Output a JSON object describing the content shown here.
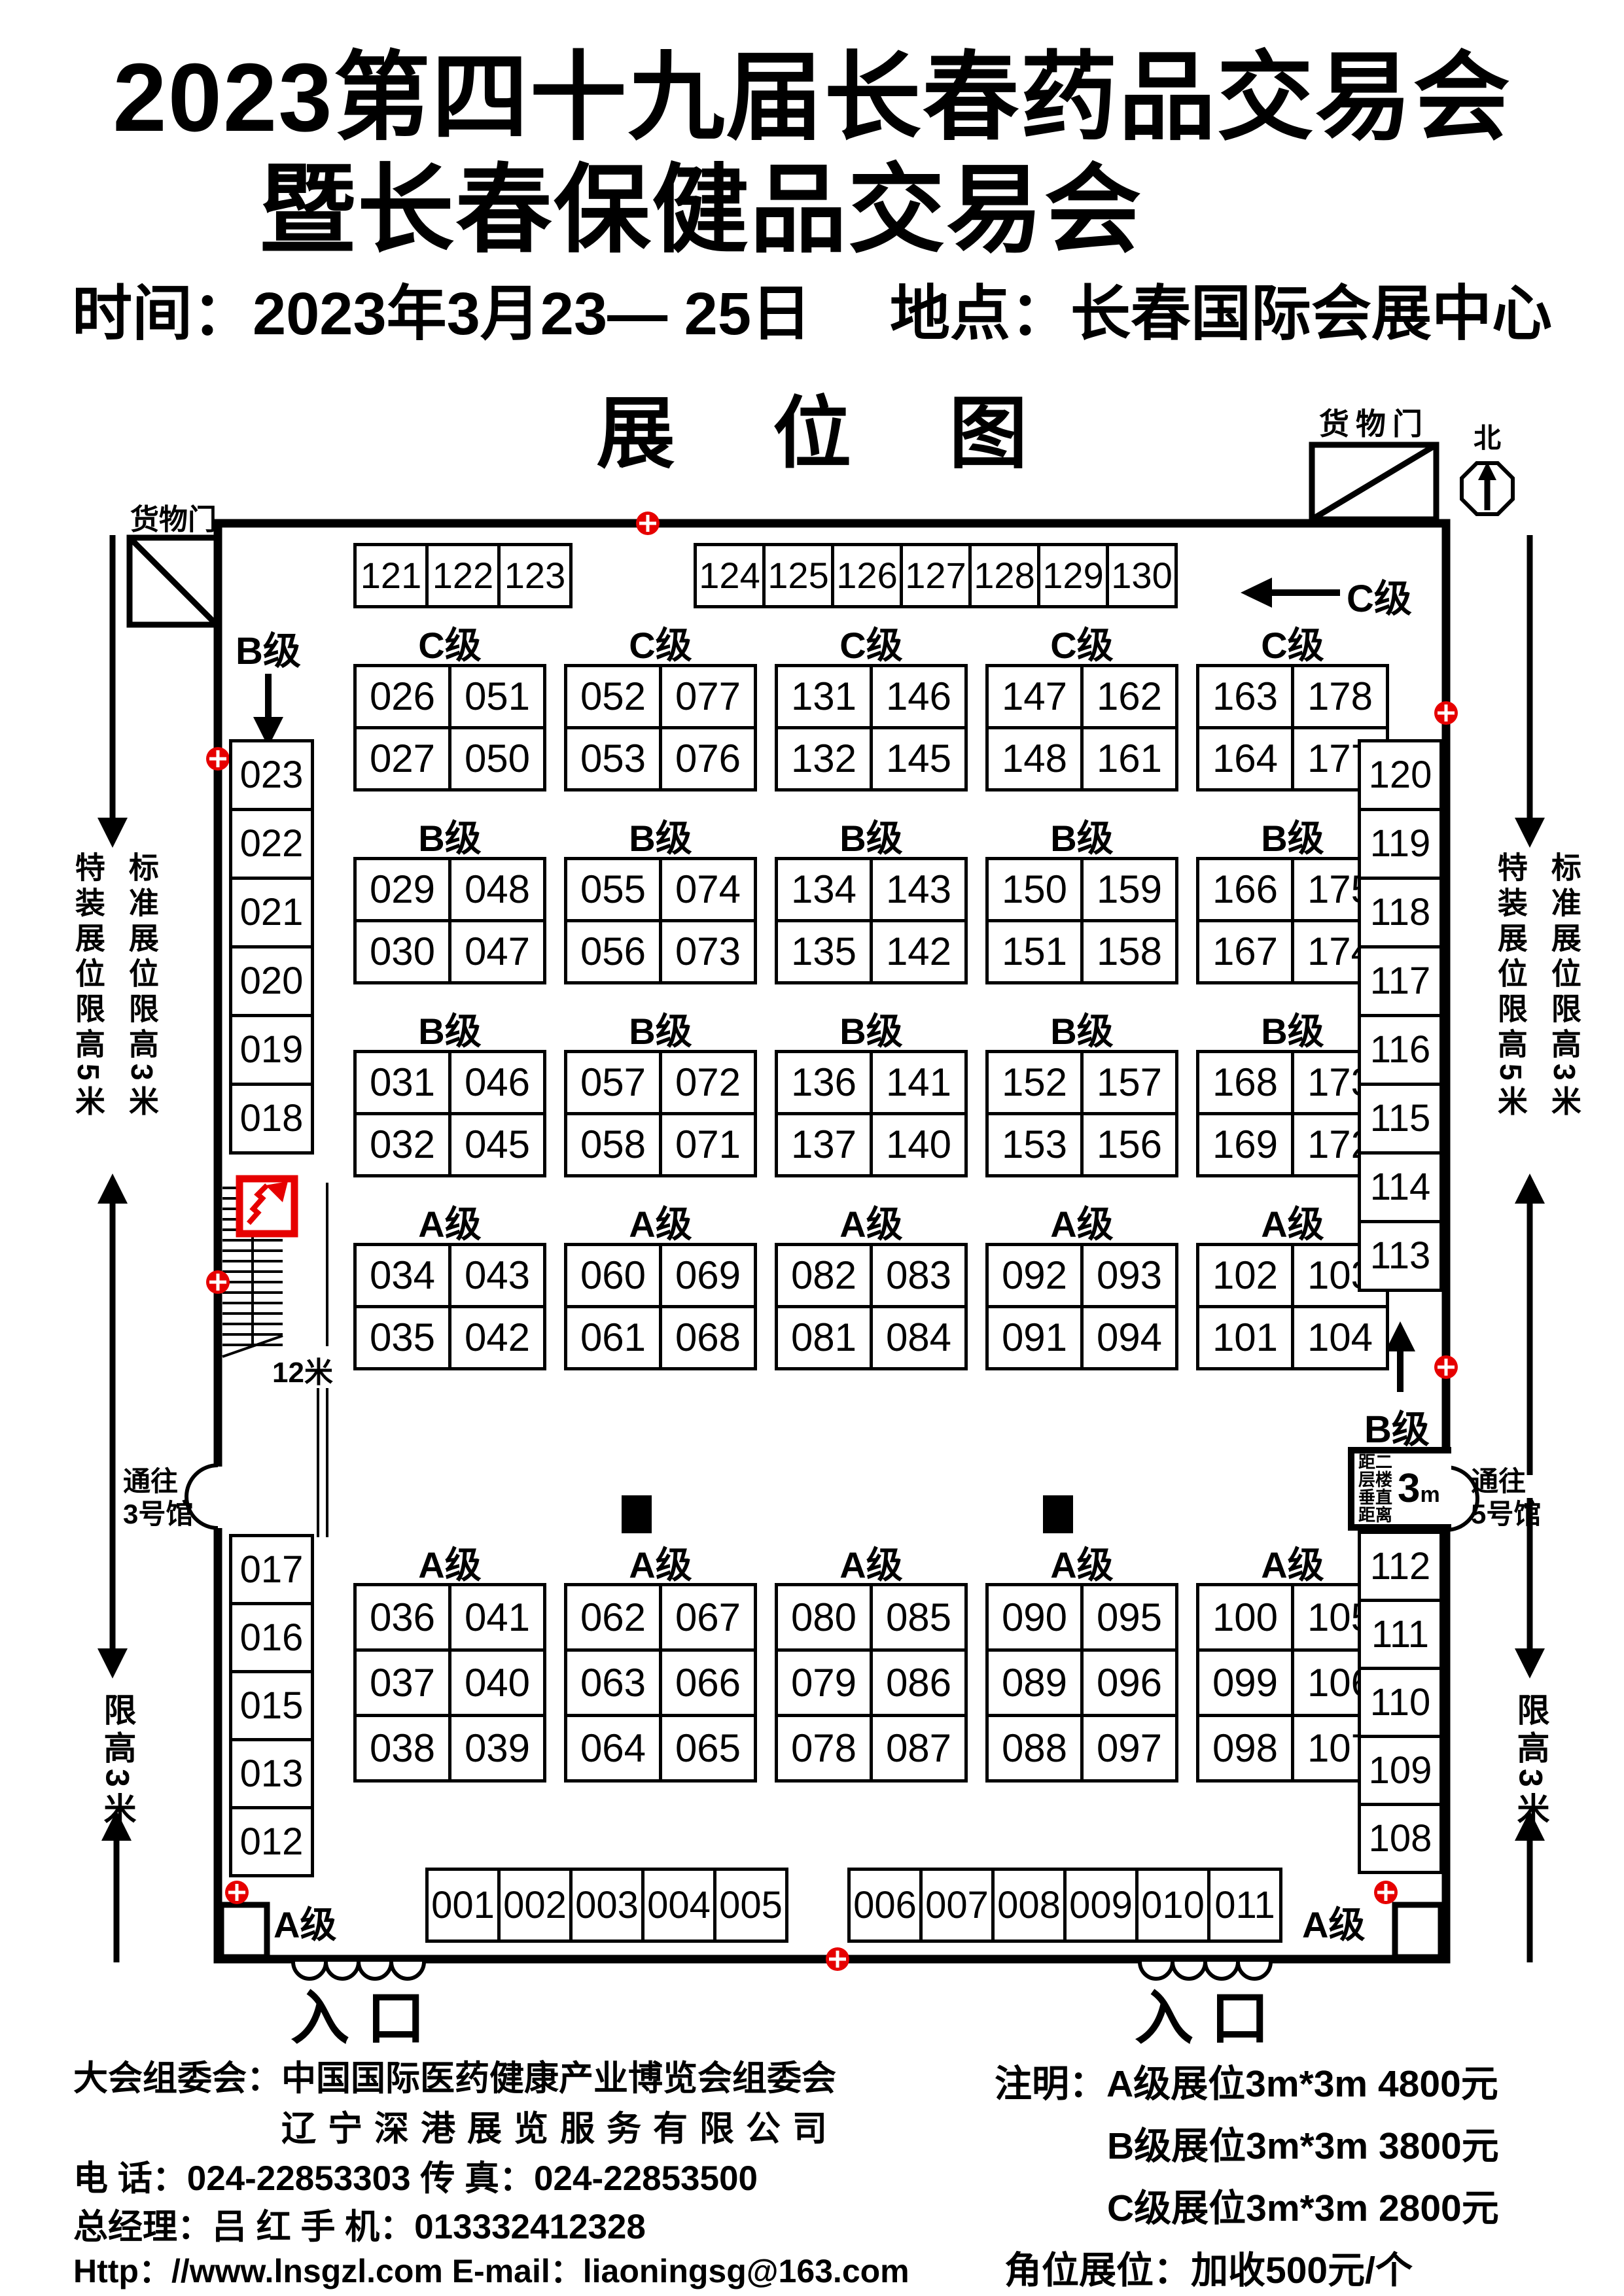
{
  "header": {
    "title_line1": "2023第四十九届长春药品交易会",
    "title_line2": "暨长春保健品交易会",
    "time_label": "时间：",
    "time_value": "2023年3月23— 25日",
    "place_label": "地点：",
    "place_value": "长春国际会展中心",
    "plan_title": "展 位 图"
  },
  "plan": {
    "cargo_door_label": "货物门",
    "north_label": "北",
    "c_grade_arrow_label": "C级",
    "b_grade_label": "B级",
    "a_corner_label": "A级",
    "entrance_label": "入口",
    "stair_width_label": "12米",
    "note_special": "特装展位限高5米",
    "note_standard": "标准展位限高3米",
    "height_limit_note": "限高3米",
    "to_hall3_line1": "通往",
    "to_hall3_line2": "3号馆",
    "to_hall5_line1": "通往",
    "to_hall5_line2": "5号馆",
    "floor_distance_lines": [
      "距二",
      "层楼",
      "垂直",
      "距离"
    ],
    "floor_distance_value": "3",
    "floor_distance_unit": "m",
    "top_row_groups": [
      [
        "121",
        "122",
        "123"
      ],
      [
        "124",
        "125",
        "126",
        "127",
        "128",
        "129",
        "130"
      ]
    ],
    "grid_rows": [
      {
        "label": "C级",
        "groups": [
          [
            [
              "026",
              "051"
            ],
            [
              "027",
              "050"
            ]
          ],
          [
            [
              "052",
              "077"
            ],
            [
              "053",
              "076"
            ]
          ],
          [
            [
              "131",
              "146"
            ],
            [
              "132",
              "145"
            ]
          ],
          [
            [
              "147",
              "162"
            ],
            [
              "148",
              "161"
            ]
          ],
          [
            [
              "163",
              "178"
            ],
            [
              "164",
              "177"
            ]
          ]
        ]
      },
      {
        "label": "B级",
        "groups": [
          [
            [
              "029",
              "048"
            ],
            [
              "030",
              "047"
            ]
          ],
          [
            [
              "055",
              "074"
            ],
            [
              "056",
              "073"
            ]
          ],
          [
            [
              "134",
              "143"
            ],
            [
              "135",
              "142"
            ]
          ],
          [
            [
              "150",
              "159"
            ],
            [
              "151",
              "158"
            ]
          ],
          [
            [
              "166",
              "175"
            ],
            [
              "167",
              "174"
            ]
          ]
        ]
      },
      {
        "label": "B级",
        "groups": [
          [
            [
              "031",
              "046"
            ],
            [
              "032",
              "045"
            ]
          ],
          [
            [
              "057",
              "072"
            ],
            [
              "058",
              "071"
            ]
          ],
          [
            [
              "136",
              "141"
            ],
            [
              "137",
              "140"
            ]
          ],
          [
            [
              "152",
              "157"
            ],
            [
              "153",
              "156"
            ]
          ],
          [
            [
              "168",
              "173"
            ],
            [
              "169",
              "172"
            ]
          ]
        ]
      },
      {
        "label": "A级",
        "groups": [
          [
            [
              "034",
              "043"
            ],
            [
              "035",
              "042"
            ]
          ],
          [
            [
              "060",
              "069"
            ],
            [
              "061",
              "068"
            ]
          ],
          [
            [
              "082",
              "083"
            ],
            [
              "081",
              "084"
            ]
          ],
          [
            [
              "092",
              "093"
            ],
            [
              "091",
              "094"
            ]
          ],
          [
            [
              "102",
              "103"
            ],
            [
              "101",
              "104"
            ]
          ]
        ]
      }
    ],
    "lower_a_row": {
      "label": "A级",
      "marked_groups": [
        1,
        3
      ],
      "groups": [
        [
          [
            "036",
            "041"
          ],
          [
            "037",
            "040"
          ],
          [
            "038",
            "039"
          ]
        ],
        [
          [
            "062",
            "067"
          ],
          [
            "063",
            "066"
          ],
          [
            "064",
            "065"
          ]
        ],
        [
          [
            "080",
            "085"
          ],
          [
            "079",
            "086"
          ],
          [
            "078",
            "087"
          ]
        ],
        [
          [
            "090",
            "095"
          ],
          [
            "089",
            "096"
          ],
          [
            "088",
            "097"
          ]
        ],
        [
          [
            "100",
            "105"
          ],
          [
            "099",
            "106"
          ],
          [
            "098",
            "107"
          ]
        ]
      ]
    },
    "bottom_row_groups": [
      [
        "001",
        "002",
        "003",
        "004",
        "005"
      ],
      [
        "006",
        "007",
        "008",
        "009",
        "010",
        "011"
      ]
    ],
    "left_column_top": [
      "023",
      "022",
      "021",
      "020",
      "019",
      "018"
    ],
    "left_column_bottom": [
      "017",
      "016",
      "015",
      "013",
      "012"
    ],
    "right_column_top": [
      "120",
      "119",
      "118",
      "117",
      "116",
      "115",
      "114",
      "113"
    ],
    "right_column_bottom": [
      "112",
      "111",
      "110",
      "109",
      "108"
    ],
    "colors": {
      "accent_red": "#e60000",
      "ink": "#000000"
    }
  },
  "footer": {
    "left_line1": "大会组委会：中国国际医药健康产业博览会组委会",
    "left_line2": "辽宁深港展览服务有限公司",
    "left_line3": "电 话：024-22853303  传 真：024-22853500",
    "left_line4": "总经理：吕 红  手 机：013332412328",
    "left_line5": "Http：//www.lnsgzl.com   E-mail：liaoningsg@163.com",
    "right_line1_label": "注明：",
    "right_line1_text": "A级展位3m*3m  4800元",
    "right_line2_text": "B级展位3m*3m  3800元",
    "right_line3_text": "C级展位3m*3m  2800元",
    "right_line4_text": "角位展位：加收500元/个"
  }
}
